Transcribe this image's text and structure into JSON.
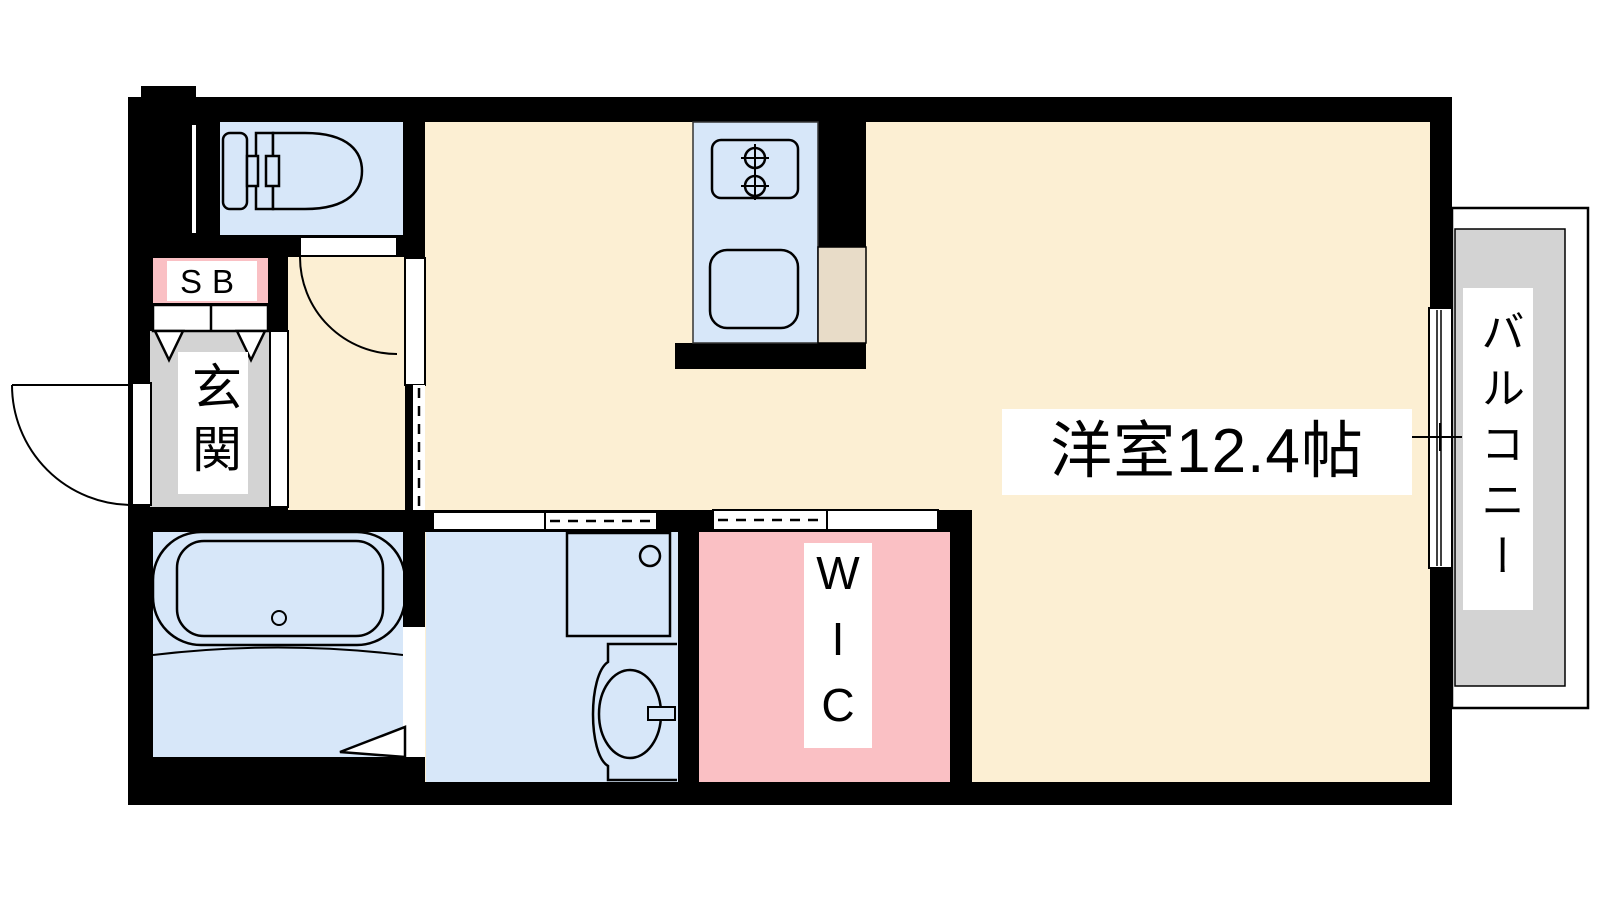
{
  "plan": {
    "kind": "apartment-floor-plan",
    "rooms": {
      "living_room": {
        "label": "洋室12.4帖",
        "area_tatami": "12.4"
      },
      "balcony": {
        "label": "バルコニー"
      },
      "entrance": {
        "label": "玄関"
      },
      "shoe_box": {
        "label": "SB"
      },
      "walk_in_closet": {
        "label": "WIC"
      }
    },
    "fixtures": {
      "toilet": "toilet",
      "bathtub": "bathtub",
      "stove": "two-burner-stove",
      "kitchen_sink": "kitchen-sink",
      "washing_machine_pan": "washing-machine-pan",
      "vanity_basin": "vanity-basin",
      "refrigerator_space": "refrigerator-space",
      "entry_door": "outward-swing-door",
      "toilet_door": "swing-door",
      "bathroom_door": "folding-door",
      "washroom_door": "sliding-door",
      "wic_door": "sliding-door",
      "balcony_window": "sliding-window"
    },
    "palette": {
      "floor_cream": "#FCEFD3",
      "wet_room_blue": "#D7E7F9",
      "closet_pink": "#FAC0C4",
      "entrance_gray": "#D3D3D3",
      "balcony_gray": "#D3D3D3",
      "appliance_beige": "#E8DCC8",
      "wall_black": "#000000",
      "label_white": "#FFFFFF"
    }
  }
}
